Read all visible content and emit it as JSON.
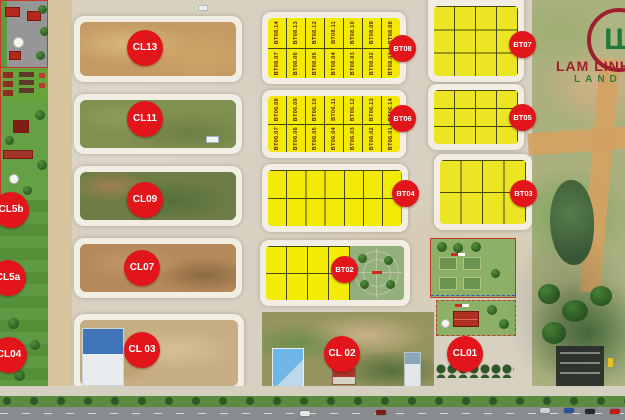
{
  "branding": {
    "name": "LAM LINH",
    "sub": "LAND",
    "monogram": "LL"
  },
  "markers": {
    "cl13": "CL13",
    "cl11": "CL11",
    "cl09": "CL09",
    "cl07": "CL07",
    "cl03": "CL 03",
    "cl02": "CL 02",
    "cl01": "CL01",
    "cl5b": "CL5b",
    "cl5a": "CL5a",
    "cl04": "CL04",
    "bt08": "BT08",
    "bt07": "BT07",
    "bt06": "BT06",
    "bt05": "BT05",
    "bt04": "BT04",
    "bt03": "BT03",
    "bt02": "BT02"
  },
  "blocks": {
    "bt08": {
      "row_top": [
        "BT08.14",
        "BT08.13",
        "BT08.12",
        "BT08.11",
        "BT08.10",
        "BT08.09",
        "BT08.08"
      ],
      "row_bottom": [
        "BT08.07",
        "BT08.06",
        "BT08.05",
        "BT08.04",
        "BT08.03",
        "BT08.02",
        "BT08.01"
      ]
    },
    "bt06": {
      "row_top": [
        "BT06.08",
        "BT06.09",
        "BT06.10",
        "BT06.11",
        "BT06.12",
        "BT06.13",
        "BT06.14"
      ],
      "row_bottom": [
        "BT06.07",
        "BT06.06",
        "BT06.05",
        "BT06.04",
        "BT06.03",
        "BT06.02",
        "BT06.01"
      ]
    }
  },
  "palette": {
    "marker_red": "#e2151b",
    "plot_yellow": "#f2ea04",
    "plot_yellow_right": "#ebe524",
    "brand_red": "#9e1f2e",
    "brand_green": "#1f7a3c"
  }
}
